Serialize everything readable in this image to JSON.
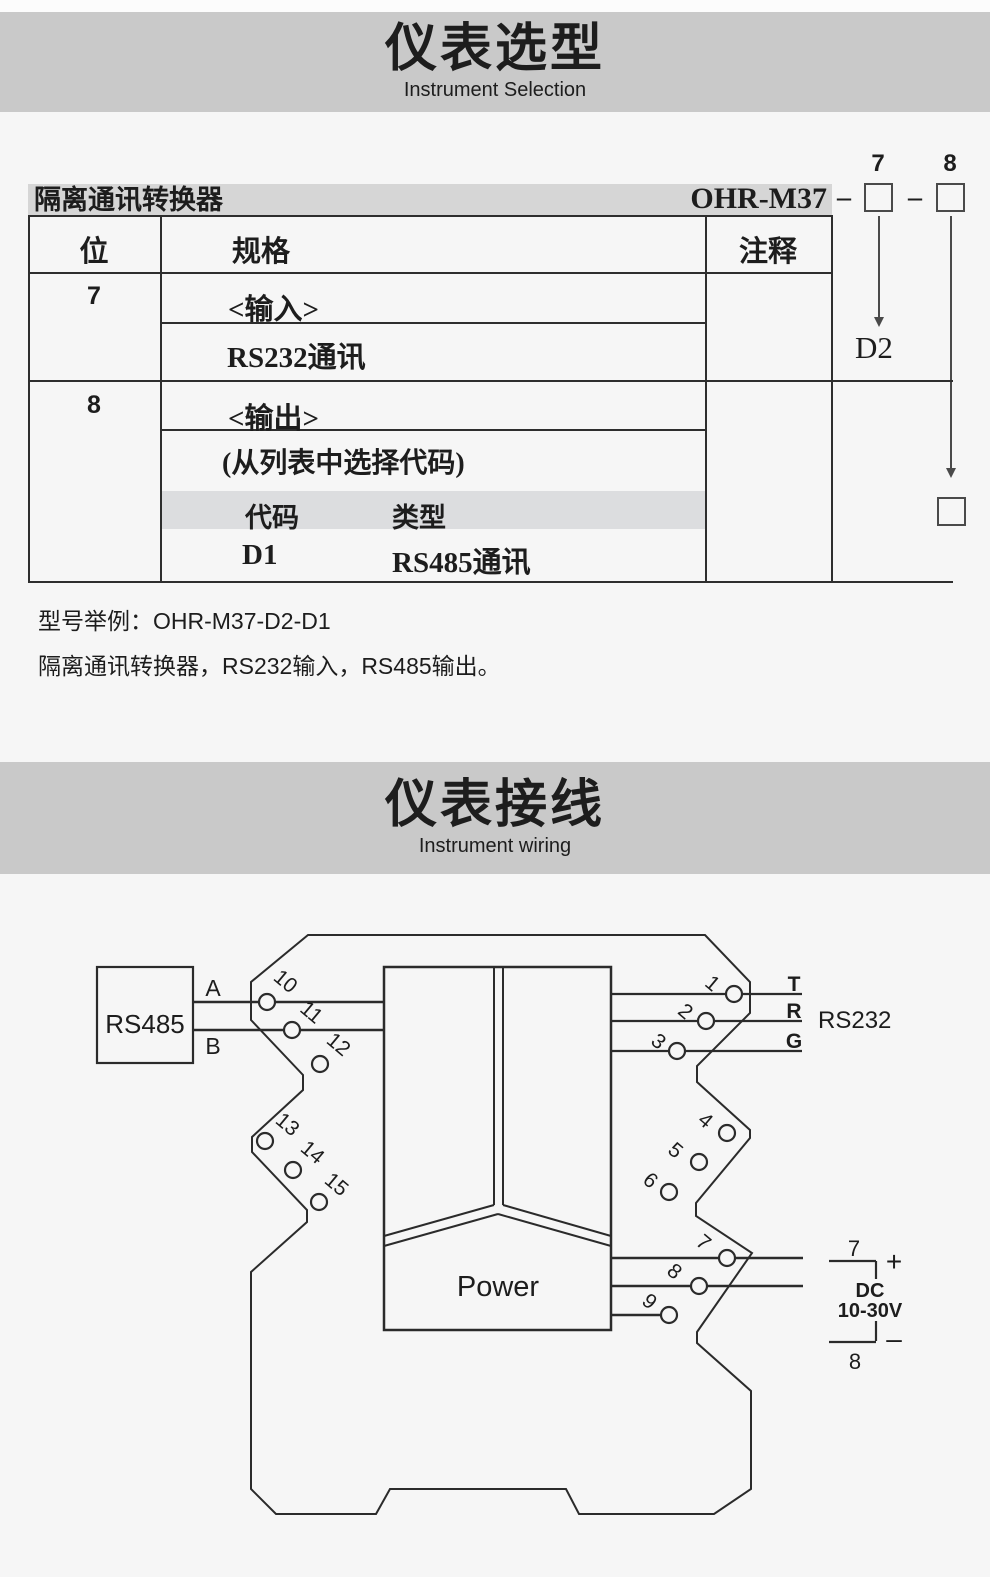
{
  "colors": {
    "page_bg": "#f6f6f6",
    "band_bg": "#c9c9c9",
    "bar_bg": "#d6d6d6",
    "stripe_bg": "#dcdddf",
    "ink": "#1d1d1d",
    "line": "#2b2b2b"
  },
  "section_selection": {
    "title": "仪表选型",
    "subtitle": "Instrument Selection",
    "product_bar": {
      "name": "隔离通讯转换器",
      "model": "OHR-M37"
    },
    "code_notation": {
      "dash": "–",
      "digit7": "7",
      "digit8": "8"
    },
    "table": {
      "headers": {
        "position": "位",
        "spec": "规格",
        "note": "注释"
      },
      "row7": {
        "digit": "7",
        "group": "<输入>",
        "item": "RS232通讯"
      },
      "row8": {
        "digit": "8",
        "group": "<输出>",
        "hint": "(从列表中选择代码)",
        "code_header": "代码",
        "type_header": "类型",
        "code": "D1",
        "type": "RS485通讯"
      },
      "d2_callout": "D2"
    },
    "example_title": "型号举例：OHR-M37-D2-D1",
    "example_desc": "隔离通讯转换器，RS232输入，RS485输出。"
  },
  "section_wiring": {
    "title": "仪表接线",
    "subtitle": "Instrument wiring",
    "rs485_label": "RS485",
    "line_a": "A",
    "line_b": "B",
    "rs232": {
      "t": "T",
      "r": "R",
      "g": "G",
      "label": "RS232"
    },
    "power_label": "Power",
    "dc": {
      "top": "7",
      "plus": "+",
      "name": "DC",
      "range": "10-30V",
      "minus": "–",
      "bottom": "8"
    },
    "terminals": [
      "1",
      "2",
      "3",
      "4",
      "5",
      "6",
      "7",
      "8",
      "9",
      "10",
      "11",
      "12",
      "13",
      "14",
      "15"
    ]
  }
}
